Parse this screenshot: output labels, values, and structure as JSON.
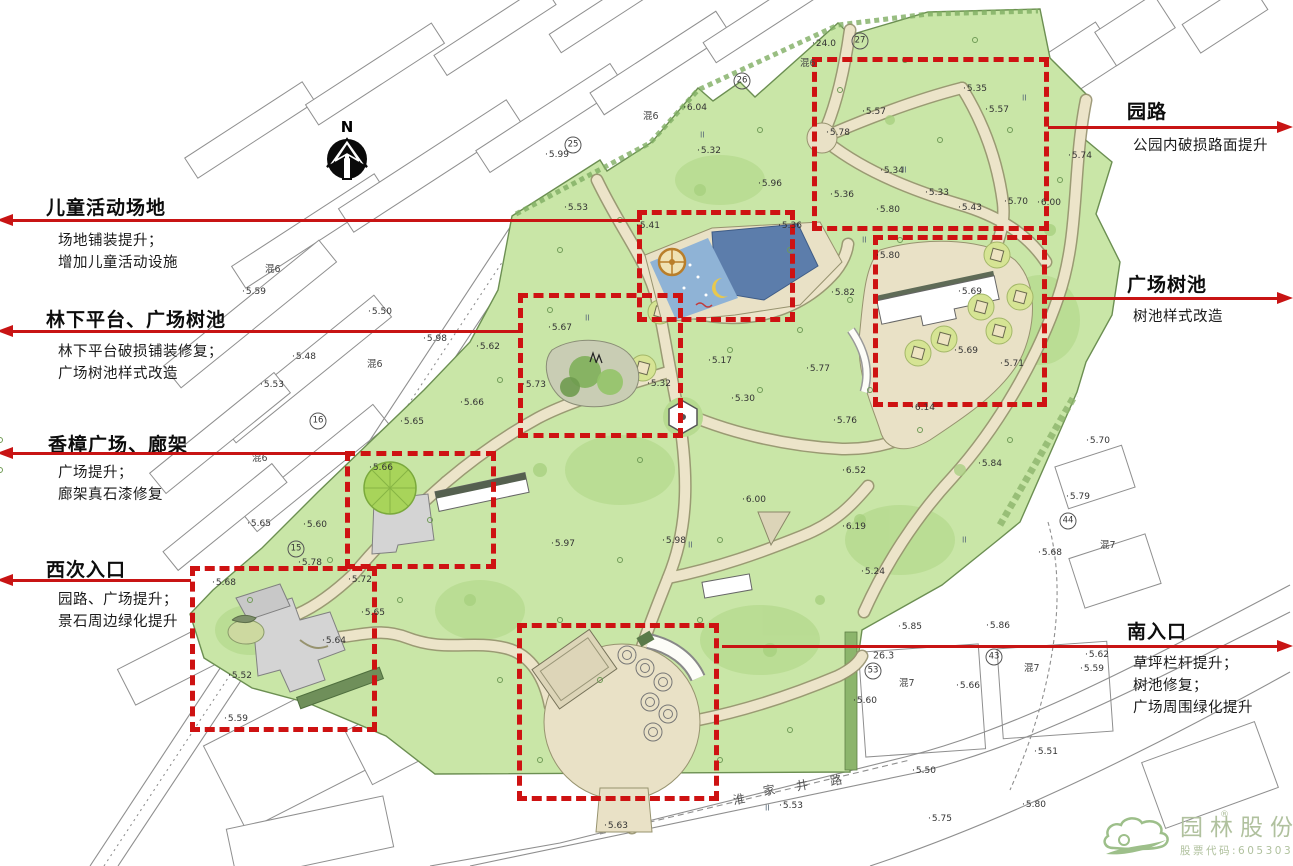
{
  "meta": {
    "width": 1293,
    "height": 866
  },
  "north": {
    "label": "N"
  },
  "annotations": {
    "left": [
      {
        "title": "儿童活动场地",
        "lines": [
          "场地铺装提升；",
          "增加儿童活动设施"
        ]
      },
      {
        "title": "林下平台、广场树池",
        "lines": [
          "林下平台破损铺装修复；",
          "广场树池样式改造"
        ]
      },
      {
        "title": "香樟广场、廊架",
        "lines": [
          "广场提升；",
          "廊架真石漆修复"
        ]
      },
      {
        "title": "西次入口",
        "lines": [
          "园路、广场提升；",
          "景石周边绿化提升"
        ]
      }
    ],
    "right": [
      {
        "title": "园路",
        "lines": [
          "公园内破损路面提升"
        ]
      },
      {
        "title": "广场树池",
        "lines": [
          "树池样式改造"
        ]
      },
      {
        "title": "南入口",
        "lines": [
          "草坪栏杆提升；",
          "树池修复；",
          "广场周围绿化提升"
        ]
      }
    ]
  },
  "zones": [
    {
      "name": "园路",
      "x": 812,
      "y": 57,
      "w": 237,
      "h": 174
    },
    {
      "name": "儿童活动场地",
      "x": 637,
      "y": 210,
      "w": 158,
      "h": 112
    },
    {
      "name": "林下平台、广场树池",
      "x": 518,
      "y": 293,
      "w": 165,
      "h": 145
    },
    {
      "name": "广场树池",
      "x": 873,
      "y": 235,
      "w": 174,
      "h": 172
    },
    {
      "name": "香樟广场、廊架",
      "x": 345,
      "y": 451,
      "w": 151,
      "h": 118
    },
    {
      "name": "西次入口",
      "x": 190,
      "y": 566,
      "w": 187,
      "h": 166
    },
    {
      "name": "南入口",
      "x": 517,
      "y": 623,
      "w": 202,
      "h": 178
    }
  ],
  "map_labels": [
    {
      "x": 545,
      "y": 155,
      "t": "5.99"
    },
    {
      "x": 683,
      "y": 108,
      "t": "6.04"
    },
    {
      "x": 812,
      "y": 44,
      "t": "24.0"
    },
    {
      "x": 643,
      "y": 115,
      "t": "混6",
      "k": "nm"
    },
    {
      "x": 800,
      "y": 62,
      "t": "混6",
      "k": "nm"
    },
    {
      "x": 862,
      "y": 112,
      "t": "5.57"
    },
    {
      "x": 963,
      "y": 89,
      "t": "5.35"
    },
    {
      "x": 985,
      "y": 110,
      "t": "5.57"
    },
    {
      "x": 826,
      "y": 133,
      "t": "5.78"
    },
    {
      "x": 880,
      "y": 171,
      "t": "5.34"
    },
    {
      "x": 925,
      "y": 193,
      "t": "5.33"
    },
    {
      "x": 830,
      "y": 195,
      "t": "5.36"
    },
    {
      "x": 876,
      "y": 210,
      "t": "5.80"
    },
    {
      "x": 958,
      "y": 208,
      "t": "5.43"
    },
    {
      "x": 1004,
      "y": 202,
      "t": "5.70"
    },
    {
      "x": 1037,
      "y": 203,
      "t": "6.00"
    },
    {
      "x": 1068,
      "y": 156,
      "t": "5.74"
    },
    {
      "x": 564,
      "y": 208,
      "t": "5.53"
    },
    {
      "x": 636,
      "y": 226,
      "t": "5.41"
    },
    {
      "x": 697,
      "y": 151,
      "t": "5.32"
    },
    {
      "x": 758,
      "y": 184,
      "t": "5.96"
    },
    {
      "x": 778,
      "y": 226,
      "t": "5.36"
    },
    {
      "x": 876,
      "y": 256,
      "t": "5.80"
    },
    {
      "x": 958,
      "y": 292,
      "t": "5.69"
    },
    {
      "x": 954,
      "y": 351,
      "t": "5.69"
    },
    {
      "x": 1000,
      "y": 364,
      "t": "5.71"
    },
    {
      "x": 831,
      "y": 293,
      "t": "5.82"
    },
    {
      "x": 548,
      "y": 328,
      "t": "5.67"
    },
    {
      "x": 522,
      "y": 385,
      "t": "5.73"
    },
    {
      "x": 647,
      "y": 384,
      "t": "5.32"
    },
    {
      "x": 708,
      "y": 361,
      "t": "5.17"
    },
    {
      "x": 731,
      "y": 399,
      "t": "5.30"
    },
    {
      "x": 806,
      "y": 369,
      "t": "5.77"
    },
    {
      "x": 833,
      "y": 421,
      "t": "5.76"
    },
    {
      "x": 842,
      "y": 471,
      "t": "6.52"
    },
    {
      "x": 742,
      "y": 500,
      "t": "6.00"
    },
    {
      "x": 842,
      "y": 527,
      "t": "6.19"
    },
    {
      "x": 861,
      "y": 572,
      "t": "5.24"
    },
    {
      "x": 911,
      "y": 408,
      "t": "6.14"
    },
    {
      "x": 978,
      "y": 464,
      "t": "5.84"
    },
    {
      "x": 662,
      "y": 541,
      "t": "5.98"
    },
    {
      "x": 551,
      "y": 544,
      "t": "5.97"
    },
    {
      "x": 369,
      "y": 468,
      "t": "5.66"
    },
    {
      "x": 348,
      "y": 580,
      "t": "5.72"
    },
    {
      "x": 298,
      "y": 563,
      "t": "5.78"
    },
    {
      "x": 212,
      "y": 583,
      "t": "5.68"
    },
    {
      "x": 361,
      "y": 613,
      "t": "5.65"
    },
    {
      "x": 322,
      "y": 641,
      "t": "5.64"
    },
    {
      "x": 228,
      "y": 676,
      "t": "5.52"
    },
    {
      "x": 224,
      "y": 719,
      "t": "5.59"
    },
    {
      "x": 242,
      "y": 292,
      "t": "5.59"
    },
    {
      "x": 368,
      "y": 312,
      "t": "5.50"
    },
    {
      "x": 423,
      "y": 339,
      "t": "5.98"
    },
    {
      "x": 292,
      "y": 357,
      "t": "5.48"
    },
    {
      "x": 476,
      "y": 347,
      "t": "5.62"
    },
    {
      "x": 260,
      "y": 385,
      "t": "5.53"
    },
    {
      "x": 460,
      "y": 403,
      "t": "5.66"
    },
    {
      "x": 400,
      "y": 422,
      "t": "5.65"
    },
    {
      "x": 303,
      "y": 525,
      "t": "5.60"
    },
    {
      "x": 247,
      "y": 524,
      "t": "5.65"
    },
    {
      "x": 265,
      "y": 268,
      "t": "混6",
      "k": "nm"
    },
    {
      "x": 367,
      "y": 363,
      "t": "混6",
      "k": "nm"
    },
    {
      "x": 252,
      "y": 457,
      "t": "混6",
      "k": "nm"
    },
    {
      "x": 604,
      "y": 826,
      "t": "5.63"
    },
    {
      "x": 779,
      "y": 806,
      "t": "5.53"
    },
    {
      "x": 733,
      "y": 799,
      "t": "淮",
      "k": "road"
    },
    {
      "x": 763,
      "y": 790,
      "t": "家",
      "k": "road"
    },
    {
      "x": 796,
      "y": 785,
      "t": "井",
      "k": "road"
    },
    {
      "x": 830,
      "y": 780,
      "t": "路",
      "k": "road"
    },
    {
      "x": 898,
      "y": 627,
      "t": "5.85"
    },
    {
      "x": 986,
      "y": 626,
      "t": "5.86"
    },
    {
      "x": 873,
      "y": 656,
      "t": "26.3",
      "k": "nm"
    },
    {
      "x": 899,
      "y": 682,
      "t": "混7",
      "k": "nm"
    },
    {
      "x": 1024,
      "y": 667,
      "t": "混7",
      "k": "nm"
    },
    {
      "x": 1085,
      "y": 655,
      "t": "5.62"
    },
    {
      "x": 1080,
      "y": 669,
      "t": "5.59"
    },
    {
      "x": 956,
      "y": 686,
      "t": "5.66"
    },
    {
      "x": 853,
      "y": 701,
      "t": "5.60"
    },
    {
      "x": 1034,
      "y": 752,
      "t": "5.51"
    },
    {
      "x": 912,
      "y": 771,
      "t": "5.50"
    },
    {
      "x": 1022,
      "y": 805,
      "t": "5.80"
    },
    {
      "x": 928,
      "y": 819,
      "t": "5.75"
    },
    {
      "x": 1086,
      "y": 441,
      "t": "5.70"
    },
    {
      "x": 1066,
      "y": 497,
      "t": "5.79"
    },
    {
      "x": 1038,
      "y": 553,
      "t": "5.68"
    },
    {
      "x": 1100,
      "y": 544,
      "t": "混7",
      "k": "nm"
    },
    {
      "x": 700,
      "y": 135,
      "t": "II",
      "k": "grs"
    },
    {
      "x": 902,
      "y": 170,
      "t": "II",
      "k": "grs"
    },
    {
      "x": 862,
      "y": 240,
      "t": "II",
      "k": "grs"
    },
    {
      "x": 585,
      "y": 318,
      "t": "II",
      "k": "grs"
    },
    {
      "x": 688,
      "y": 545,
      "t": "II",
      "k": "grs"
    },
    {
      "x": 962,
      "y": 540,
      "t": "II",
      "k": "grs"
    },
    {
      "x": 1022,
      "y": 98,
      "t": "II",
      "k": "grs"
    },
    {
      "x": 765,
      "y": 808,
      "t": "II",
      "k": "grs"
    }
  ],
  "circled_labels": [
    {
      "x": 573,
      "y": 145,
      "t": "25"
    },
    {
      "x": 742,
      "y": 81,
      "t": "26"
    },
    {
      "x": 860,
      "y": 41,
      "t": "27"
    },
    {
      "x": 318,
      "y": 421,
      "t": "16"
    },
    {
      "x": 296,
      "y": 549,
      "t": "15"
    },
    {
      "x": 873,
      "y": 671,
      "t": "53"
    },
    {
      "x": 994,
      "y": 657,
      "t": "43"
    },
    {
      "x": 1068,
      "y": 521,
      "t": "44"
    }
  ],
  "logo": {
    "company": "园林股份",
    "stock": "股票代码:605303",
    "registered": "®"
  },
  "colors": {
    "accent_red": "#c81414",
    "park_green": "#c9e6a7",
    "path_beige": "#ece4c9",
    "pond_blue": "#5c7dab",
    "logo_green": "#b0c19e"
  }
}
